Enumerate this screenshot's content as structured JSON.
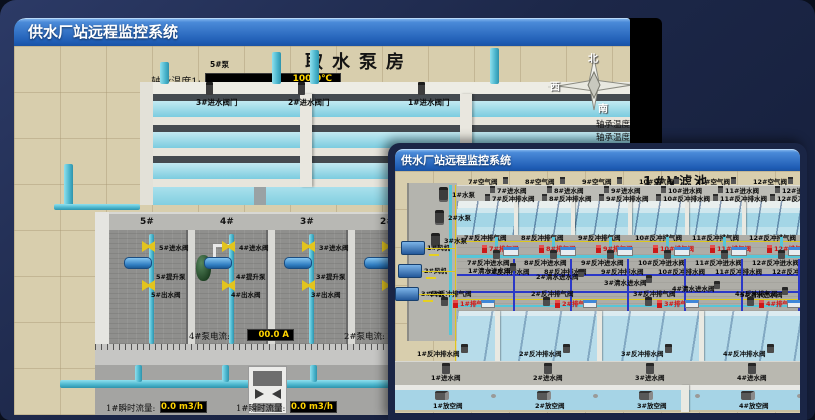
{
  "back_window": {
    "title": "供水厂站远程监控系统",
    "scene_title": "取水泵房",
    "pump_panel": {
      "header": "5#泵",
      "rows": [
        {
          "label": "轴承温度1:",
          "value": "100.0℃"
        },
        {
          "label": "轴承温度2:",
          "value": "100.0℃"
        },
        {
          "label": "电机温度1:",
          "value": "18.1℃"
        },
        {
          "label": "电机温度2:",
          "value": "17.9℃"
        },
        {
          "label": "绕组温度1:",
          "value": "18.0℃"
        },
        {
          "label": "绕组温度2:",
          "value": "18.1℃"
        },
        {
          "label": "绕组温度3:",
          "value": "18.1℃"
        },
        {
          "label": "管道压力:",
          "value": "0.0007MPa"
        },
        {
          "label": "多功能阀:",
          "value": "0%"
        }
      ]
    },
    "intake_valves": [
      "3#进水阀门",
      "2#进水阀门",
      "1#进水阀门"
    ],
    "compass": {
      "north": "北",
      "west": "西",
      "south": "南"
    },
    "partial_labels": [
      "轴承温度1",
      "轴承温度2"
    ],
    "pump_bays": [
      {
        "bay": "5#",
        "inlet": "5#进水阀",
        "pump": "5#提升泵",
        "outlet": "5#出水阀"
      },
      {
        "bay": "4#",
        "inlet": "4#进水阀",
        "pump": "4#提升泵",
        "outlet": "4#出水阀"
      },
      {
        "bay": "3#",
        "inlet": "3#进水阀",
        "pump": "3#提升泵",
        "outlet": "3#出水阀"
      },
      {
        "bay": "2#",
        "inlet": "2#进水阀",
        "pump": "2#提升泵",
        "outlet": "2#出水阀"
      }
    ],
    "current_displays": [
      {
        "label": "4#泵电流:",
        "value": "00.0 A"
      },
      {
        "label": "2#泵电流:",
        "value": "00.0 A"
      }
    ],
    "flow_displays": [
      {
        "label": "1#瞬时流量:",
        "value": "0.0 m3/h"
      },
      {
        "label": "1#瞬时流量:",
        "value": "0.0 m3/h"
      }
    ]
  },
  "front_window": {
    "title": "供水厂站远程监控系统",
    "scene_title": "1#V滤池",
    "left_equipment": {
      "pumps": [
        "1#水泵",
        "2#水泵",
        "3#水泵"
      ],
      "blowers": [
        "1#风机",
        "2#风机",
        "3#风机"
      ]
    },
    "top_cells": [
      {
        "air": "7#空气阀",
        "inlet": "7#进水阀",
        "drain1": "7#反冲排水阀",
        "vent": "7#反冲排气阀",
        "exhaust": "7#排气阀",
        "bw_inlet": "7#反冲进水阀",
        "bw_drain": "7#反冲排水阀"
      },
      {
        "air": "8#空气阀",
        "inlet": "8#进水阀",
        "drain1": "8#反冲排水阀",
        "vent": "8#反冲排气阀",
        "exhaust": "8#排气阀",
        "bw_inlet": "8#反冲进水阀",
        "bw_drain": "8#反冲排水阀"
      },
      {
        "air": "9#空气阀",
        "inlet": "9#进水阀",
        "drain1": "9#反冲排水阀",
        "vent": "9#反冲排气阀",
        "exhaust": "9#排气阀",
        "bw_inlet": "9#反冲进水阀",
        "bw_drain": "9#反冲排水阀"
      },
      {
        "air": "10#空气阀",
        "inlet": "10#进水阀",
        "drain1": "10#反冲排水阀",
        "vent": "10#反冲排气阀",
        "exhaust": "10#排气阀",
        "bw_inlet": "10#反冲进水阀",
        "bw_drain": "10#反冲排水阀"
      },
      {
        "air": "11#空气阀",
        "inlet": "11#进水阀",
        "drain1": "11#反冲排水阀",
        "vent": "11#反冲排气阀",
        "exhaust": "11#排气阀",
        "bw_inlet": "11#反冲进水阀",
        "bw_drain": "11#反冲排水阀"
      },
      {
        "air": "12#空气阀",
        "inlet": "12#进水阀",
        "drain1": "12#反冲排水阀",
        "vent": "12#反冲排气阀",
        "exhaust": "12#排气阀",
        "bw_inlet": "12#反冲进水阀",
        "bw_drain": "12#反冲排水阀"
      }
    ],
    "clean_water_valves": [
      "1#清水进水阀",
      "2#清水进水阀",
      "3#清水进水阀",
      "4#清水进水阀",
      "5#清水进水阀"
    ],
    "bottom_cells": [
      {
        "vent": "1#反冲排气阀",
        "exhaust": "1#排气阀",
        "drain": "1#反冲排水阀",
        "inlet": "1#进水阀",
        "empty": "1#放空阀"
      },
      {
        "vent": "2#反冲排气阀",
        "exhaust": "2#排气阀",
        "drain": "2#反冲排水阀",
        "inlet": "2#进水阀",
        "empty": "2#放空阀"
      },
      {
        "vent": "3#反冲排气阀",
        "exhaust": "3#排气阀",
        "drain": "3#反冲排水阀",
        "inlet": "3#进水阀",
        "empty": "3#放空阀"
      },
      {
        "vent": "4#反冲排气阀",
        "exhaust": "4#排气阀",
        "drain": "4#反冲排水阀",
        "inlet": "4#进水阀",
        "empty": "4#放空阀"
      },
      {
        "vent": "5#反冲排气阀",
        "exhaust": "5#排气阀",
        "drain": "5#反冲排水阀",
        "inlet": "5#进水阀",
        "empty": "5#放空阀"
      }
    ]
  }
}
